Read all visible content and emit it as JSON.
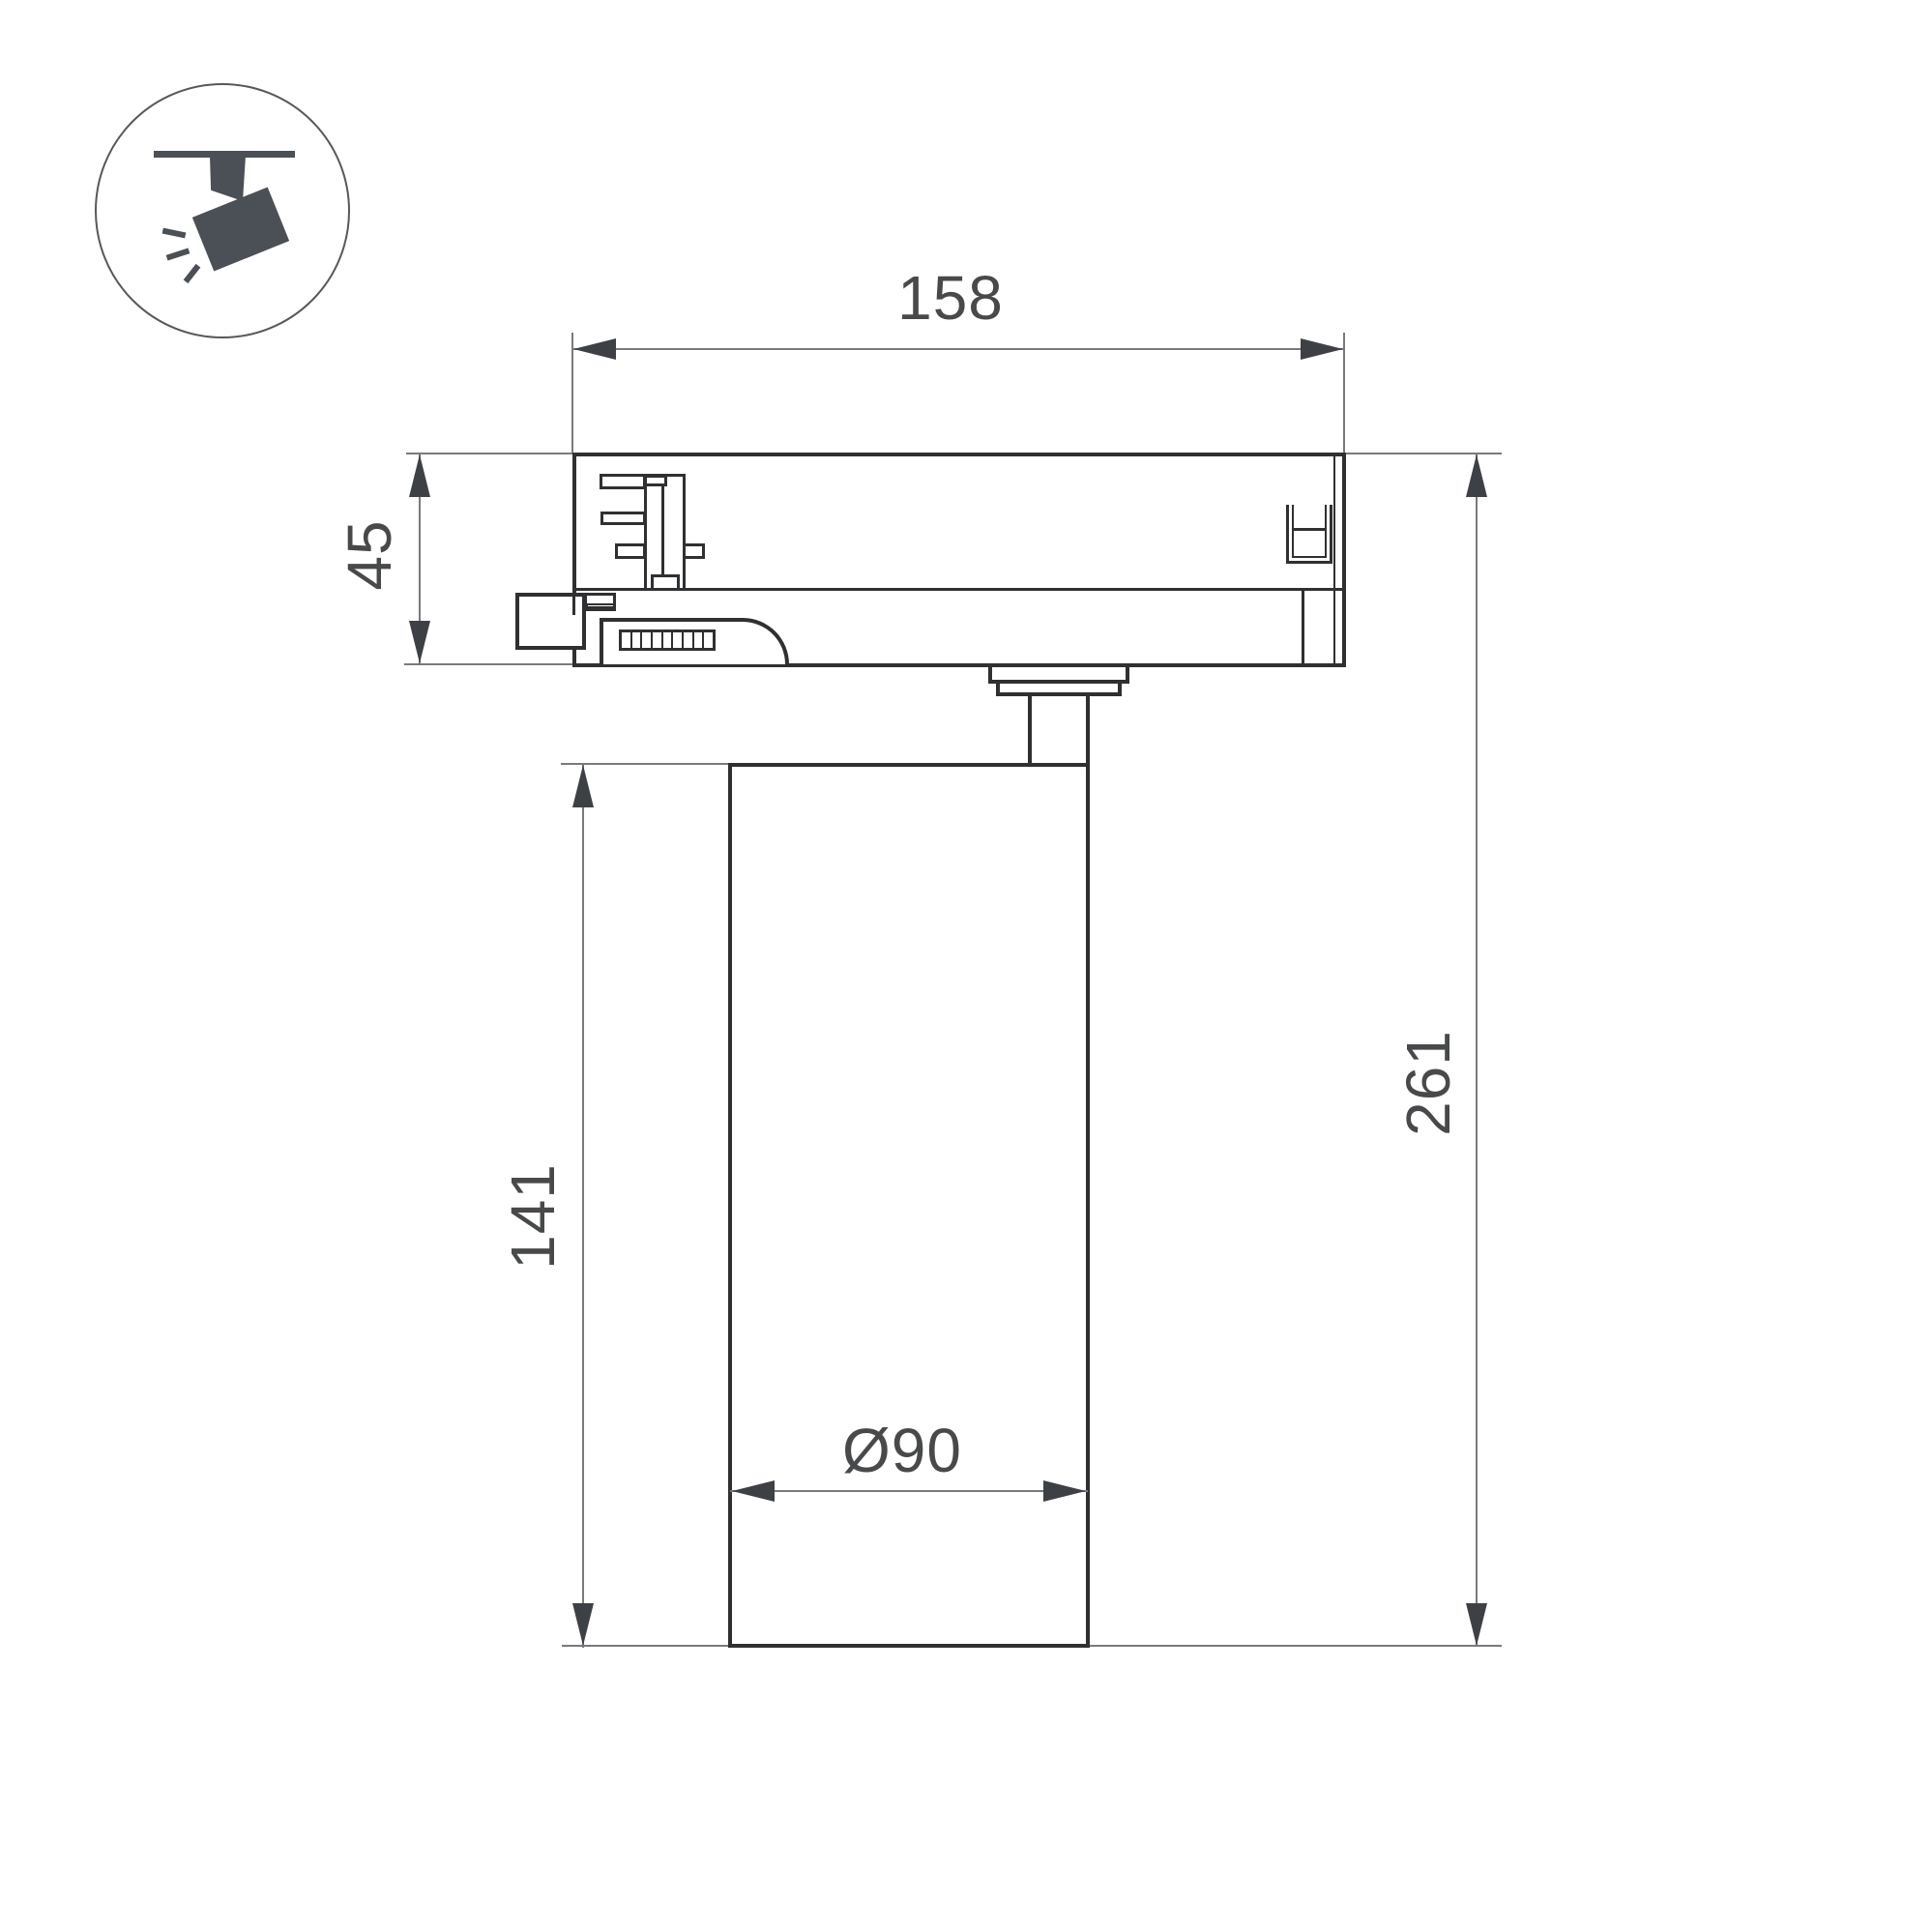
{
  "drawing": {
    "kind": "track-spotlight-dimension-drawing",
    "icon": "track-spotlight-icon",
    "dimensions": {
      "adapter_width": "158",
      "adapter_height": "45",
      "body_height": "141",
      "overall_height": "261",
      "body_diameter": "Ø90"
    },
    "colors": {
      "outline": "#2e3032",
      "dimension_line": "#7a7a7a",
      "arrow": "#3d4145",
      "label_text": "#48494b",
      "icon_fill": "#4b5056",
      "background": "#ffffff"
    }
  }
}
